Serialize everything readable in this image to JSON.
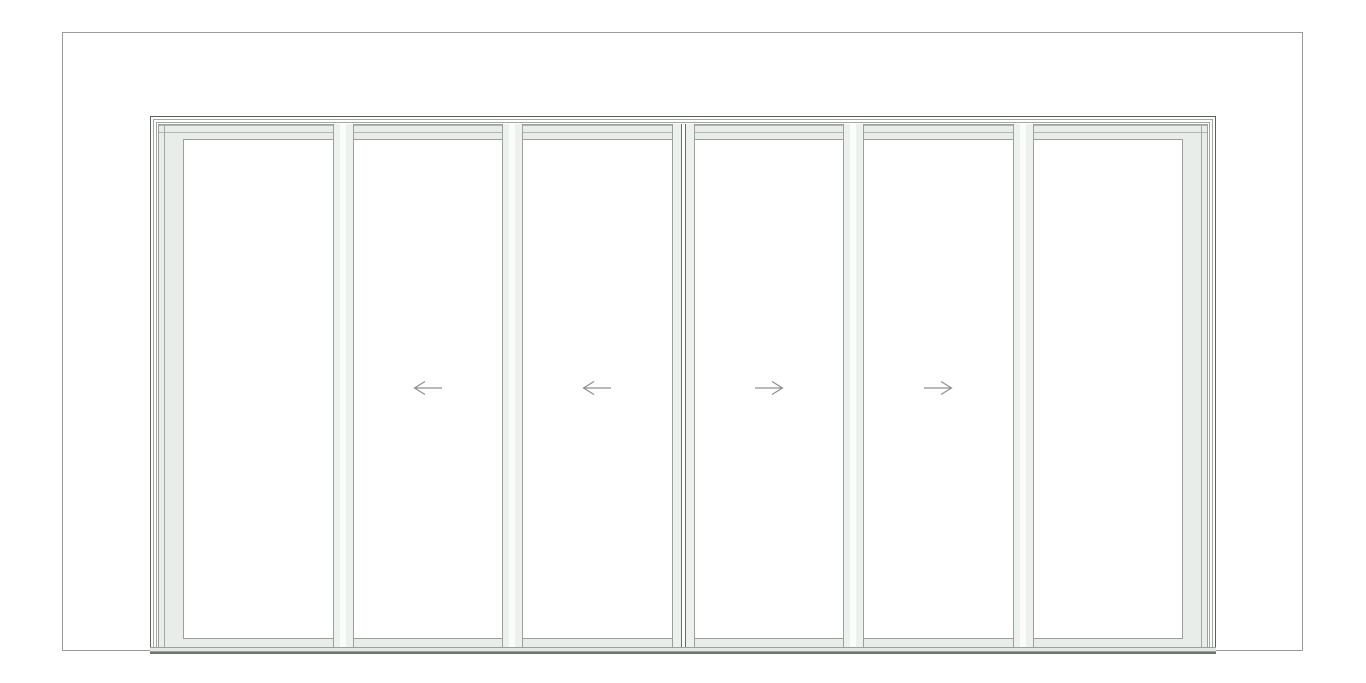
{
  "drawing": {
    "kind": "sliding-door-elevation",
    "description": "Front elevation of a six panel sliding glass door centered in a wall opening",
    "panel_count": 6
  },
  "door": {
    "panels": [
      {
        "id": 1,
        "role": "fixed-panel",
        "slide": null
      },
      {
        "id": 2,
        "role": "sliding-panel",
        "slide": "left"
      },
      {
        "id": 3,
        "role": "sliding-panel",
        "slide": "left"
      },
      {
        "id": 4,
        "role": "sliding-panel",
        "slide": "right"
      },
      {
        "id": 5,
        "role": "sliding-panel",
        "slide": "right"
      },
      {
        "id": 6,
        "role": "fixed-panel",
        "slide": null
      }
    ],
    "arrow_icons": {
      "left": "slide-left-arrow-icon",
      "right": "slide-right-arrow-icon"
    }
  },
  "colors": {
    "background": "#ffffff",
    "wall_outline": "#9b9b9b",
    "frame_dark": "#5c615c",
    "frame_line": "#9aa09a",
    "frame_line_soft": "#a2a7a2",
    "frame_fill": "#e9ede9",
    "pane_fill": "#ffffff",
    "mullion_fill": "#edf1ed",
    "mullion_gap": "#fbfdfb",
    "astragal": "#686d68",
    "sill_fill": "#e4e8e4",
    "sill_dark": "#6f746f",
    "arrow": "#8f8f8f"
  }
}
